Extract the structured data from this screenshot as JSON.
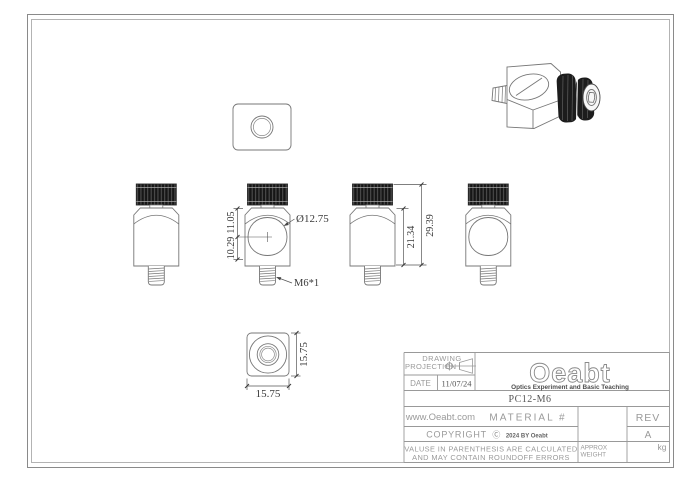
{
  "document": {
    "type": "engineering-drawing",
    "part_number": "PC12-M6"
  },
  "dimensions": {
    "bore_diameter": "Ø12.75",
    "center_to_top": "11.05",
    "center_to_bottom": "10.29",
    "thread_spec": "M6*1",
    "body_height": "21.34",
    "overall_height": "29.39",
    "base_width": "15.75",
    "base_depth": "15.75"
  },
  "title_block": {
    "drawing_label": "DRAWING",
    "projection_label": "PROJECTION",
    "date_label": "DATE",
    "date_value": "11/07/24",
    "logo_text": "Oeabt",
    "logo_tagline": "Optics Experiment and Basic Teaching",
    "part_number": "PC12-M6",
    "website": "www.Oeabt.com",
    "material_label": "MATERIAL #",
    "rev_label": "REV",
    "rev_value": "A",
    "copyright_label": "COPYRIGHT",
    "copyright_symbol": "Ⓒ",
    "copyright_suffix": "2024 BY Oeabt",
    "disclaimer_line1": "VALUSE IN PARENTHESIS ARE CALCULATED",
    "disclaimer_line2": "AND MAY CONTAIN ROUNDOFF ERRORS",
    "approx_weight_line1": "APPROX",
    "approx_weight_line2": "WEIGHT",
    "weight_unit": "kg"
  },
  "colors": {
    "geometry_line": "#777777",
    "dimension_line": "#555555",
    "dimension_text": "#3a3a3a",
    "table_line": "#999999",
    "knurl_fill": "#161616",
    "frame_outer": "#8a8a8a",
    "frame_inner": "#b3b3b3"
  }
}
